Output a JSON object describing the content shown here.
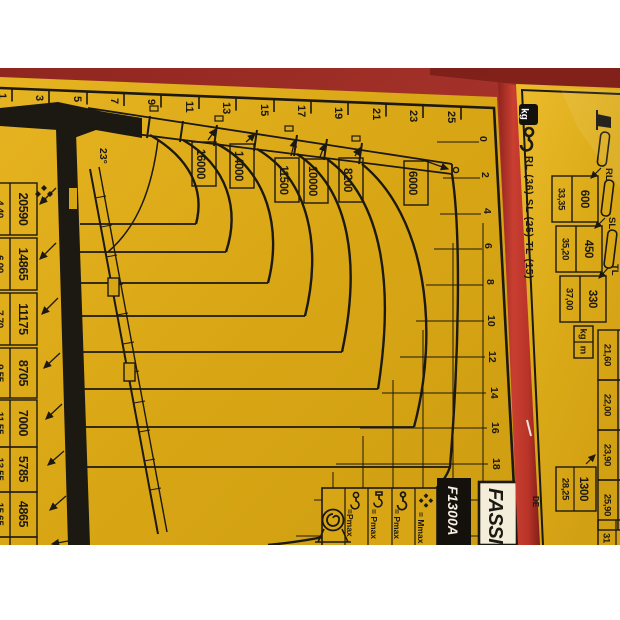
{
  "panel1": {
    "height_axis": [
      "1",
      "3",
      "5",
      "7",
      "9",
      "11",
      "13",
      "15",
      "17",
      "19",
      "21",
      "23",
      "25"
    ],
    "outreach_axis": [
      "0",
      "2",
      "4",
      "6",
      "8",
      "10",
      "12",
      "14",
      "16",
      "18"
    ],
    "boom_angle": "23°",
    "curve_labels": [
      "16000",
      "14000",
      "11500",
      "10000",
      "8200",
      "6000"
    ],
    "capacity_table": [
      {
        "load": "20590",
        "m": "4,40"
      },
      {
        "load": "14865",
        "m": "6,00"
      },
      {
        "load": "11175",
        "m": "7,70"
      },
      {
        "load": "8705",
        "m": "9,55"
      },
      {
        "load": "7000",
        "m": "11,55"
      },
      {
        "load": "5785",
        "m": "13,55"
      },
      {
        "load": "4865",
        "m": "15,65"
      },
      {
        "load": "4150",
        "m": "17,85"
      }
    ],
    "legend": {
      "mmax_label": "= Mmax",
      "pmax1_label": "= Pmax",
      "pmax2_label": "= Pmax",
      "pmax3_label": "=Pmax"
    },
    "model": "F1300A",
    "brand": "FASSI"
  },
  "panel2": {
    "unit_badge": "kg",
    "caption": "RL (36) SL (25) TL (15)",
    "jib_labels": [
      "RL",
      "SL",
      "TL"
    ],
    "jib_table": [
      {
        "load": "600",
        "m": "33,35"
      },
      {
        "load": "450",
        "m": "35,20"
      },
      {
        "load": "330",
        "m": "37,00"
      }
    ],
    "units": {
      "load": "kg",
      "reach": "m"
    },
    "clipped_m_values": [
      "21,60",
      "22,00",
      "23,90",
      "25,90"
    ],
    "extra_rows": [
      {
        "load": "1300",
        "m": "28,25"
      },
      {
        "load": "90",
        "m": "31"
      }
    ],
    "edge_text": "DE"
  },
  "chart_data": {
    "type": "line",
    "title": "FASSI F1300A crane load diagram (photographed placard, rotated 90° CW)",
    "x_axis_ticks_m": [
      0,
      2,
      4,
      6,
      8,
      10,
      12,
      14,
      16,
      18
    ],
    "y_axis_ticks_m": [
      1,
      3,
      5,
      7,
      9,
      11,
      13,
      15,
      17,
      19,
      21,
      23,
      25
    ],
    "grid": true,
    "boom_angle_deg": 23,
    "curve_capacities_kg": [
      16000,
      14000,
      11500,
      10000,
      8200,
      6000
    ],
    "capacity_vs_outreach": [
      {
        "outreach_m": 4.4,
        "load_kg": 20590
      },
      {
        "outreach_m": 6.0,
        "load_kg": 14865
      },
      {
        "outreach_m": 7.7,
        "load_kg": 11175
      },
      {
        "outreach_m": 9.55,
        "load_kg": 8705
      },
      {
        "outreach_m": 11.55,
        "load_kg": 7000
      },
      {
        "outreach_m": 13.55,
        "load_kg": 5785
      },
      {
        "outreach_m": 15.65,
        "load_kg": 4865
      },
      {
        "outreach_m": 17.85,
        "load_kg": 4150
      }
    ],
    "jib_versions": {
      "labels": [
        "RL (36)",
        "SL (25)",
        "TL (15)"
      ],
      "points": [
        {
          "outreach_m": 33.35,
          "load_kg": 600
        },
        {
          "outreach_m": 35.2,
          "load_kg": 450
        },
        {
          "outreach_m": 37.0,
          "load_kg": 330
        },
        {
          "outreach_m": 28.25,
          "load_kg": 1300
        }
      ]
    },
    "legend_position": "bottom-right"
  }
}
